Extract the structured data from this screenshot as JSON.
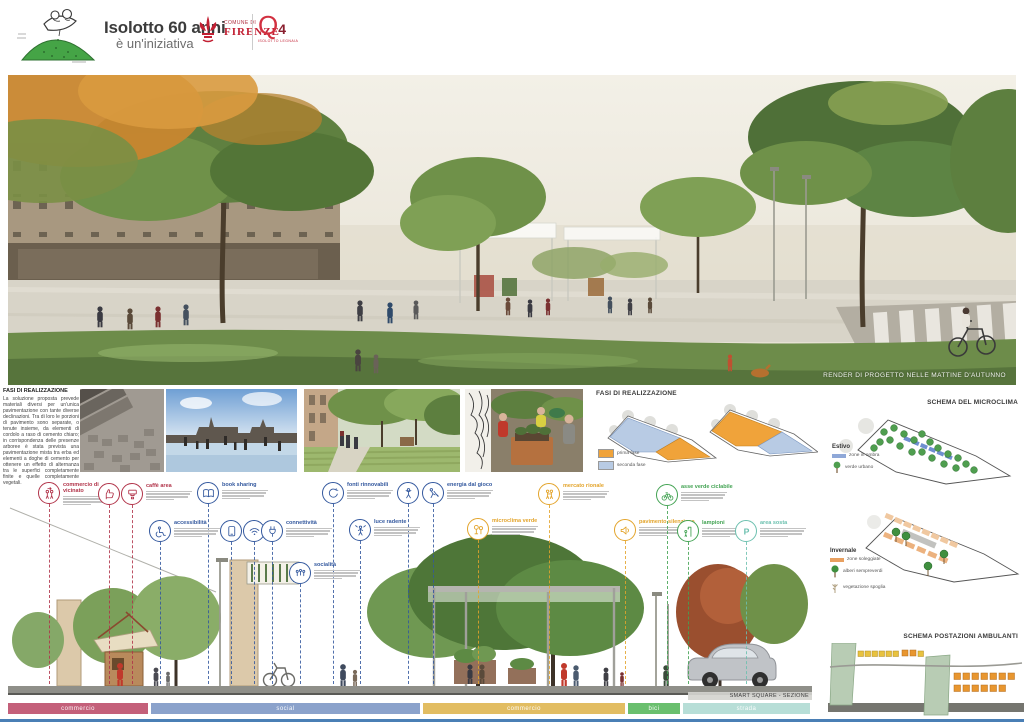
{
  "header": {
    "title_line1": "Isolotto 60 anni",
    "title_line2": "è un'iniziativa",
    "comune": {
      "line1": "COMUNE DI",
      "line2": "FIRENZE"
    },
    "q4": {
      "q": "Q",
      "n": "4",
      "sub": "ISOLOTTO LEGNAIA"
    }
  },
  "render": {
    "caption": "RENDER DI PROGETTO NELLE MATTINE D'AUTUNNO"
  },
  "fasi_text": {
    "title": "FASI DI REALIZZAZIONE",
    "body": "La soluzione proposta prevede materiali diversi per un'unica pavimentazione con tante diverse declinazioni. Tra di loro le porzioni di pavimento sono separate, o tenute insieme, da elementi di cordolo a raso di cemento chiaro; in corrispondenza delle presenze arboree è stata prevista una pavimentazione mista tra erba ed elementi a doghe di cemento per ottenere un effetto di alternanza tra le superfici completamente finite e quelle completamente vegetali."
  },
  "fasi_diagram": {
    "title": "FASI DI REALIZZAZIONE",
    "legend": [
      {
        "label": "prima fase",
        "color": "#f0a33a"
      },
      {
        "label": "seconda fase",
        "color": "#b8cbe4"
      }
    ]
  },
  "microclima": {
    "title": "SCHEMA DEL MICROCLIMA",
    "estivo": {
      "label": "Estivo",
      "legend": [
        {
          "label": "zone in ombra",
          "color": "#8fa8d8"
        },
        {
          "label": "verde urbano",
          "color": "#4f9e4f"
        }
      ]
    },
    "invernale": {
      "label": "Invernale",
      "legend": [
        {
          "label": "zone soleggiate",
          "color": "#e8a060"
        },
        {
          "label": "alberi sempreverdi",
          "color": "#3f8f3f"
        },
        {
          "label": "vegetazione spoglia",
          "color": "#b0a080"
        }
      ]
    }
  },
  "ambulanti": {
    "title": "SCHEMA POSTAZIONI AMBULANTI"
  },
  "features": [
    {
      "icon": "people-exchange",
      "label": "commercio di vicinato",
      "color": "#b13349",
      "x": 49,
      "y": 493,
      "desc": true
    },
    {
      "icon": "thumbs-up",
      "label": "",
      "color": "#b13349",
      "x": 109,
      "y": 494,
      "desc": false
    },
    {
      "icon": "espresso",
      "label": "caffè area",
      "color": "#b13349",
      "x": 132,
      "y": 494,
      "desc": true
    },
    {
      "icon": "book",
      "label": "book sharing",
      "color": "#33589e",
      "x": 208,
      "y": 493,
      "desc": true
    },
    {
      "icon": "wheelchair",
      "label": "accessibilità",
      "color": "#33589e",
      "x": 160,
      "y": 531,
      "desc": true
    },
    {
      "icon": "tablet",
      "label": "",
      "color": "#33589e",
      "x": 231,
      "y": 531,
      "desc": false
    },
    {
      "icon": "wifi",
      "label": "",
      "color": "#33589e",
      "x": 254,
      "y": 531,
      "desc": false
    },
    {
      "icon": "plug",
      "label": "connettività",
      "color": "#33589e",
      "x": 272,
      "y": 531,
      "desc": true
    },
    {
      "icon": "renewable",
      "label": "fonti rinnovabili",
      "color": "#33589e",
      "x": 333,
      "y": 493,
      "desc": true
    },
    {
      "icon": "person-play",
      "label": "",
      "color": "#33589e",
      "x": 408,
      "y": 493,
      "desc": false
    },
    {
      "icon": "person-dig",
      "label": "energia dal gioco",
      "color": "#33589e",
      "x": 433,
      "y": 493,
      "desc": true
    },
    {
      "icon": "person-light",
      "label": "luce radente",
      "color": "#33589e",
      "x": 360,
      "y": 530,
      "desc": true
    },
    {
      "icon": "people-social",
      "label": "socialità",
      "color": "#33589e",
      "x": 300,
      "y": 573,
      "desc": true
    },
    {
      "icon": "trees",
      "label": "microclima verde",
      "color": "#e3a42b",
      "x": 478,
      "y": 529,
      "desc": true
    },
    {
      "icon": "people-market",
      "label": "mercato rionale",
      "color": "#e3a42b",
      "x": 549,
      "y": 494,
      "desc": true
    },
    {
      "icon": "megaphone",
      "label": "pavimento silenzioso",
      "color": "#e3a42b",
      "x": 625,
      "y": 530,
      "desc": true
    },
    {
      "icon": "bicycle",
      "label": "asse verde ciclabile",
      "color": "#43a353",
      "x": 667,
      "y": 495,
      "desc": true
    },
    {
      "icon": "lamp-person",
      "label": "lampioni",
      "color": "#43a353",
      "x": 688,
      "y": 531,
      "desc": true
    },
    {
      "icon": "parking",
      "label": "area sosta",
      "color": "#6cc0af",
      "x": 746,
      "y": 531,
      "desc": true
    }
  ],
  "section": {
    "title": "SMART SQUARE - SEZIONE",
    "bar": [
      {
        "label": "commercio",
        "color": "#c4607a",
        "x": 8,
        "w": 140
      },
      {
        "label": "social",
        "color": "#8ba2cb",
        "x": 151,
        "w": 269
      },
      {
        "label": "commercio",
        "color": "#e2bd62",
        "x": 423,
        "w": 202
      },
      {
        "label": "bici",
        "color": "#6abf6e",
        "x": 628,
        "w": 52
      },
      {
        "label": "strada",
        "color": "#b7ded7",
        "x": 683,
        "w": 127
      }
    ]
  }
}
